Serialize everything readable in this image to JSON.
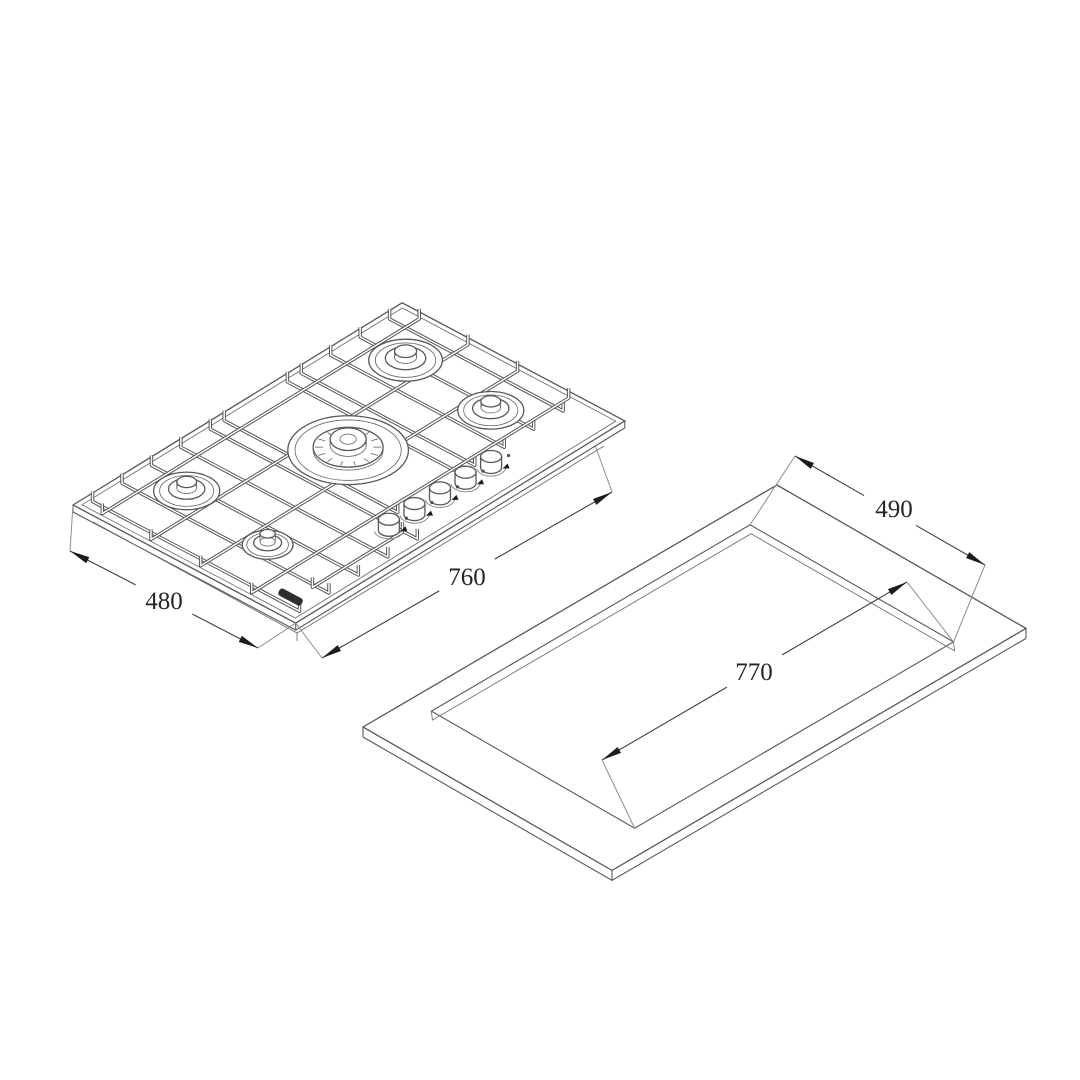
{
  "diagram": {
    "cooktop": {
      "width_mm": "760",
      "depth_mm": "480",
      "burner_count": 5,
      "knob_count": 5
    },
    "cutout": {
      "width_mm": "770",
      "depth_mm": "490"
    },
    "colors": {
      "line": "#585858",
      "arrow": "#1c1c1c",
      "text": "#262626",
      "background": "#ffffff"
    }
  }
}
